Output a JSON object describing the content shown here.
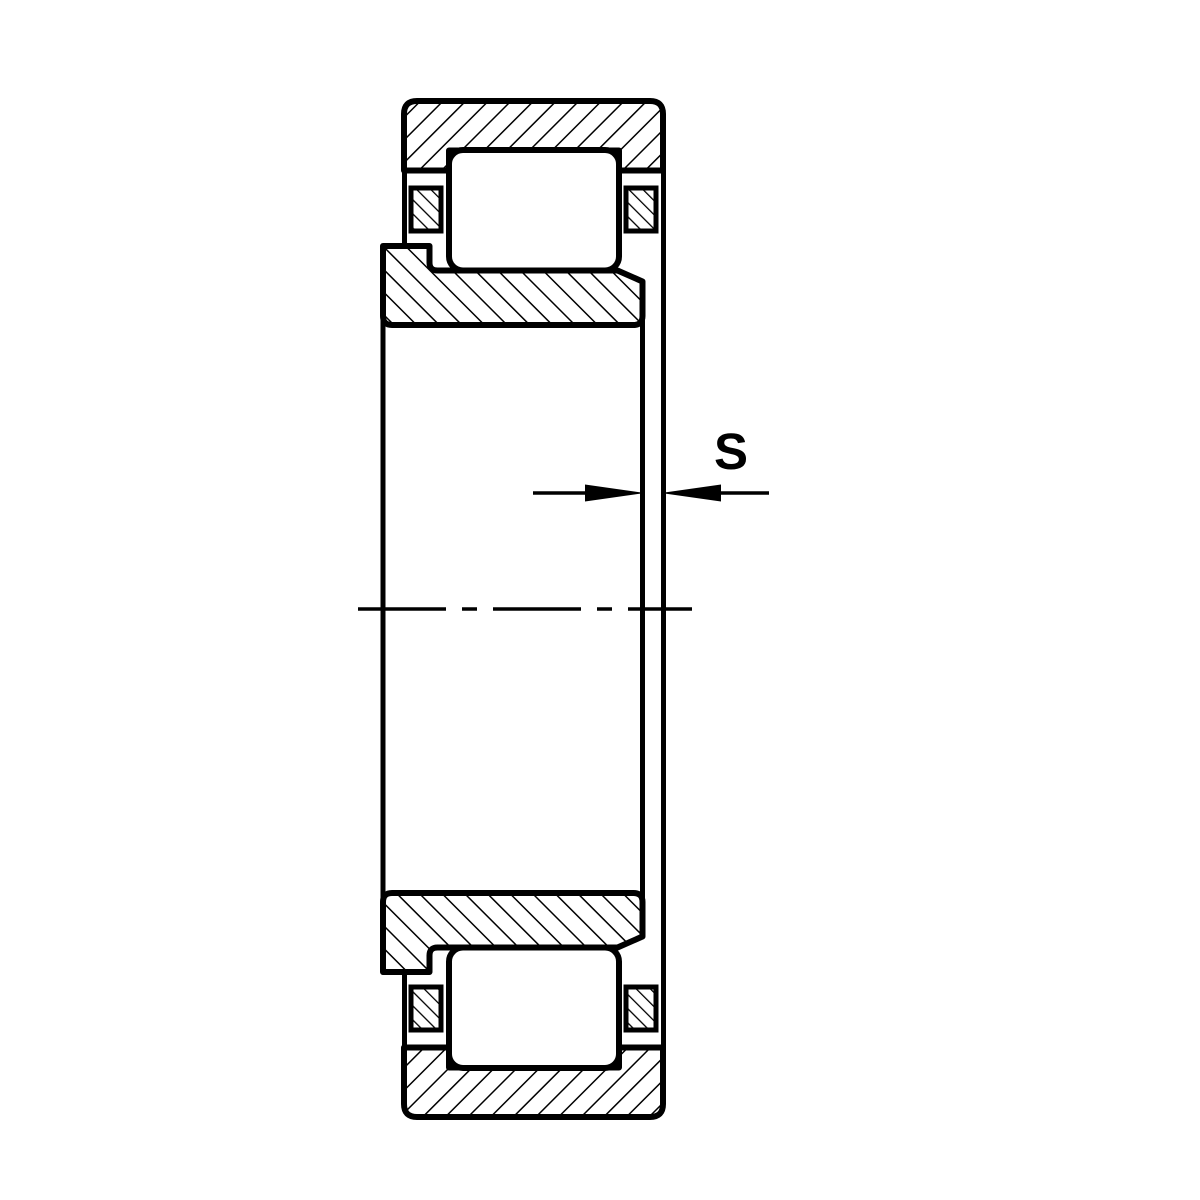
{
  "figure": {
    "background_color": "#ffffff",
    "line_color": "#000000",
    "dimension": {
      "label": "S"
    }
  }
}
